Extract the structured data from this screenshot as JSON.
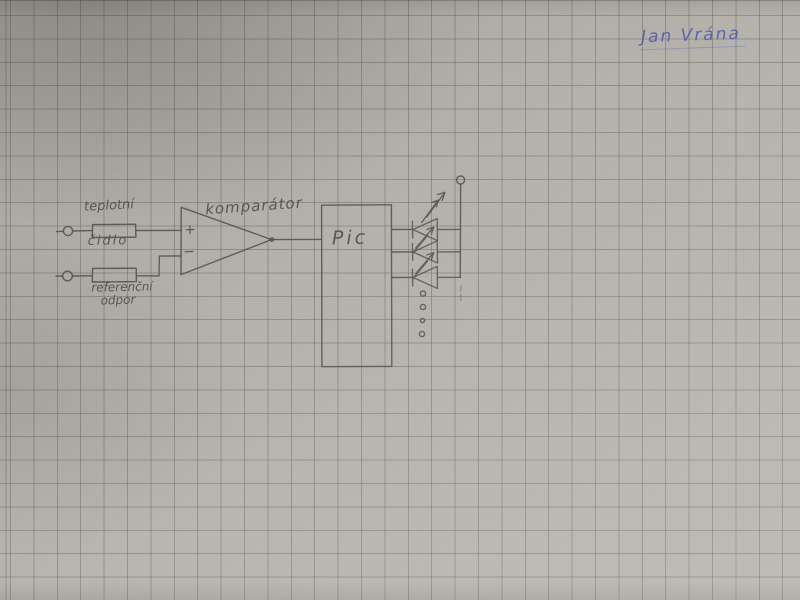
{
  "page": {
    "kind": "hand-drawn electronic schematic on squared graph paper",
    "signature": "Jan Vrána"
  },
  "schematic": {
    "labels": {
      "sensor_word_top": "teplotní",
      "sensor_word_bottom": "čidlo",
      "reference_word_top": "referenční",
      "reference_word_bottom": "odpor",
      "comparator": "komparátor",
      "mcu": "Pic",
      "plus_input": "+",
      "minus_input": "−"
    },
    "components": [
      {
        "symbol": "terminal-circle",
        "role": "top input terminal"
      },
      {
        "symbol": "resistor-box",
        "label": "teplotní čidlo"
      },
      {
        "symbol": "terminal-circle",
        "role": "bottom input terminal"
      },
      {
        "symbol": "resistor-box",
        "label": "referenční odpor"
      },
      {
        "symbol": "opamp-triangle",
        "label": "komparátor"
      },
      {
        "symbol": "ic-box",
        "label": "Pic"
      },
      {
        "symbol": "led-with-emission-arrows",
        "count_drawn": 3
      },
      {
        "symbol": "ellipsis-dots",
        "count": 4
      },
      {
        "symbol": "terminal-circle",
        "role": "supply terminal above LED bus"
      }
    ]
  },
  "colors": {
    "paper": "#b4b2ab",
    "grid_line": "#97958d",
    "pencil": "#56524b",
    "pen_ink": "#4d57ae"
  }
}
